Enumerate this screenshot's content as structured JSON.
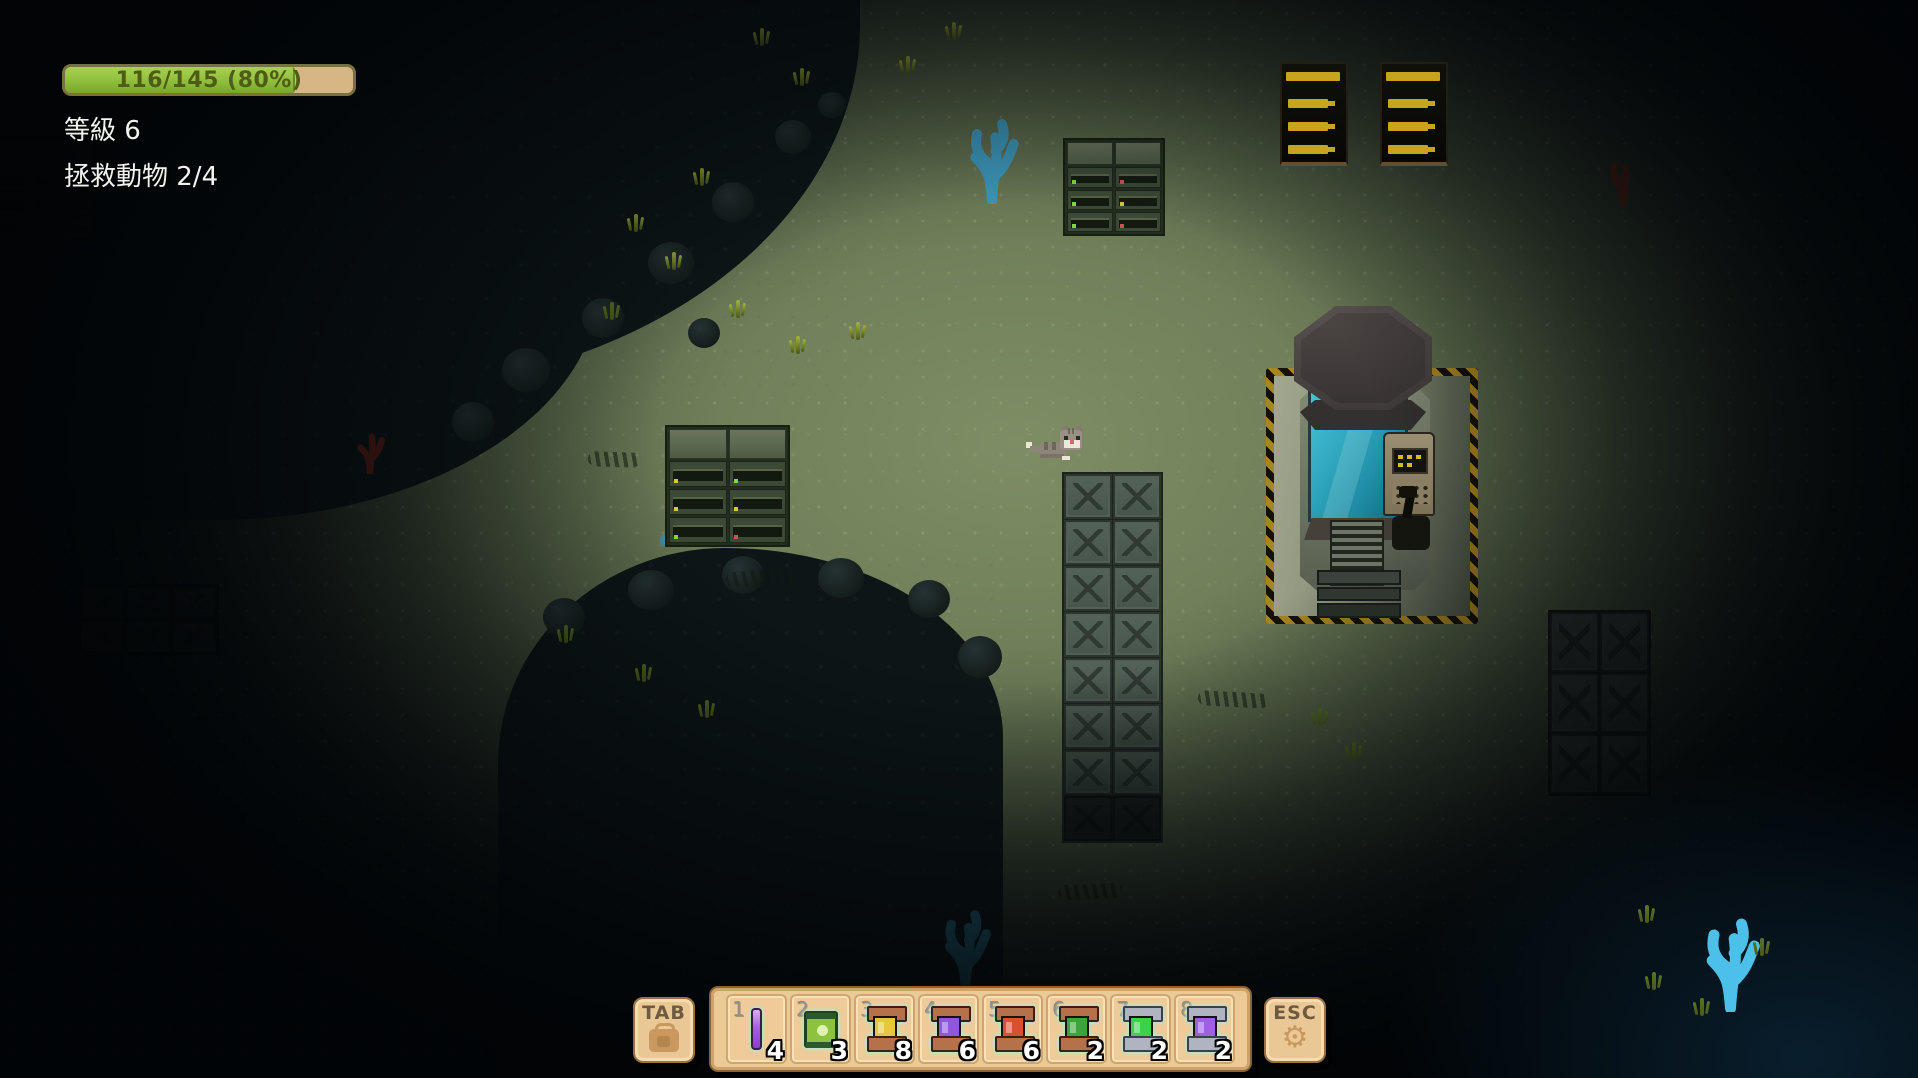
{
  "hud": {
    "health_bar": {
      "text": "116/145 (80%)",
      "current": "116",
      "max": "145",
      "percent": "80",
      "fill_css": "width:80%",
      "fill_color": "#8fbe3e",
      "track_color": "#d7b686",
      "border_color": "#77713f",
      "text_color": "#4f5c16"
    },
    "level_text": "等級 6",
    "objective_text": "拯救動物 2/4"
  },
  "hotbar": {
    "tab_key": {
      "label": "TAB",
      "icon": "backpack-icon"
    },
    "esc_key": {
      "label": "ESC",
      "icon": "gear-icon",
      "glyph": "⚙"
    },
    "panel_color": "#ecca96",
    "slots": [
      {
        "number": "1",
        "count": "4",
        "item": "purple-crystal-rod",
        "color": "#a85fe0"
      },
      {
        "number": "2",
        "count": "3",
        "item": "green-supply-pack",
        "color": "#8cc23e"
      },
      {
        "number": "3",
        "count": "8",
        "item": "copper-spool-yellow",
        "color": "#e7c53c"
      },
      {
        "number": "4",
        "count": "6",
        "item": "copper-spool-purple",
        "color": "#9257d8"
      },
      {
        "number": "5",
        "count": "6",
        "item": "copper-spool-red",
        "color": "#d8512e"
      },
      {
        "number": "6",
        "count": "2",
        "item": "copper-spool-green",
        "color": "#3aa53a"
      },
      {
        "number": "7",
        "count": "2",
        "item": "steel-canister-green",
        "color": "#3fd04a"
      },
      {
        "number": "8",
        "count": "2",
        "item": "steel-canister-purple",
        "color": "#a05fe0"
      }
    ]
  },
  "scene": {
    "player": "gray-cat",
    "colors": {
      "floor_lit": "#77865e",
      "shadow": "#060c0e",
      "water_glow": "#1e5a7e",
      "coral_bright": "#4cc0e8",
      "hazard_yellow": "#a8861e",
      "tank_glass": "#2da4bb",
      "vent_yellow": "#c7a41d"
    }
  }
}
